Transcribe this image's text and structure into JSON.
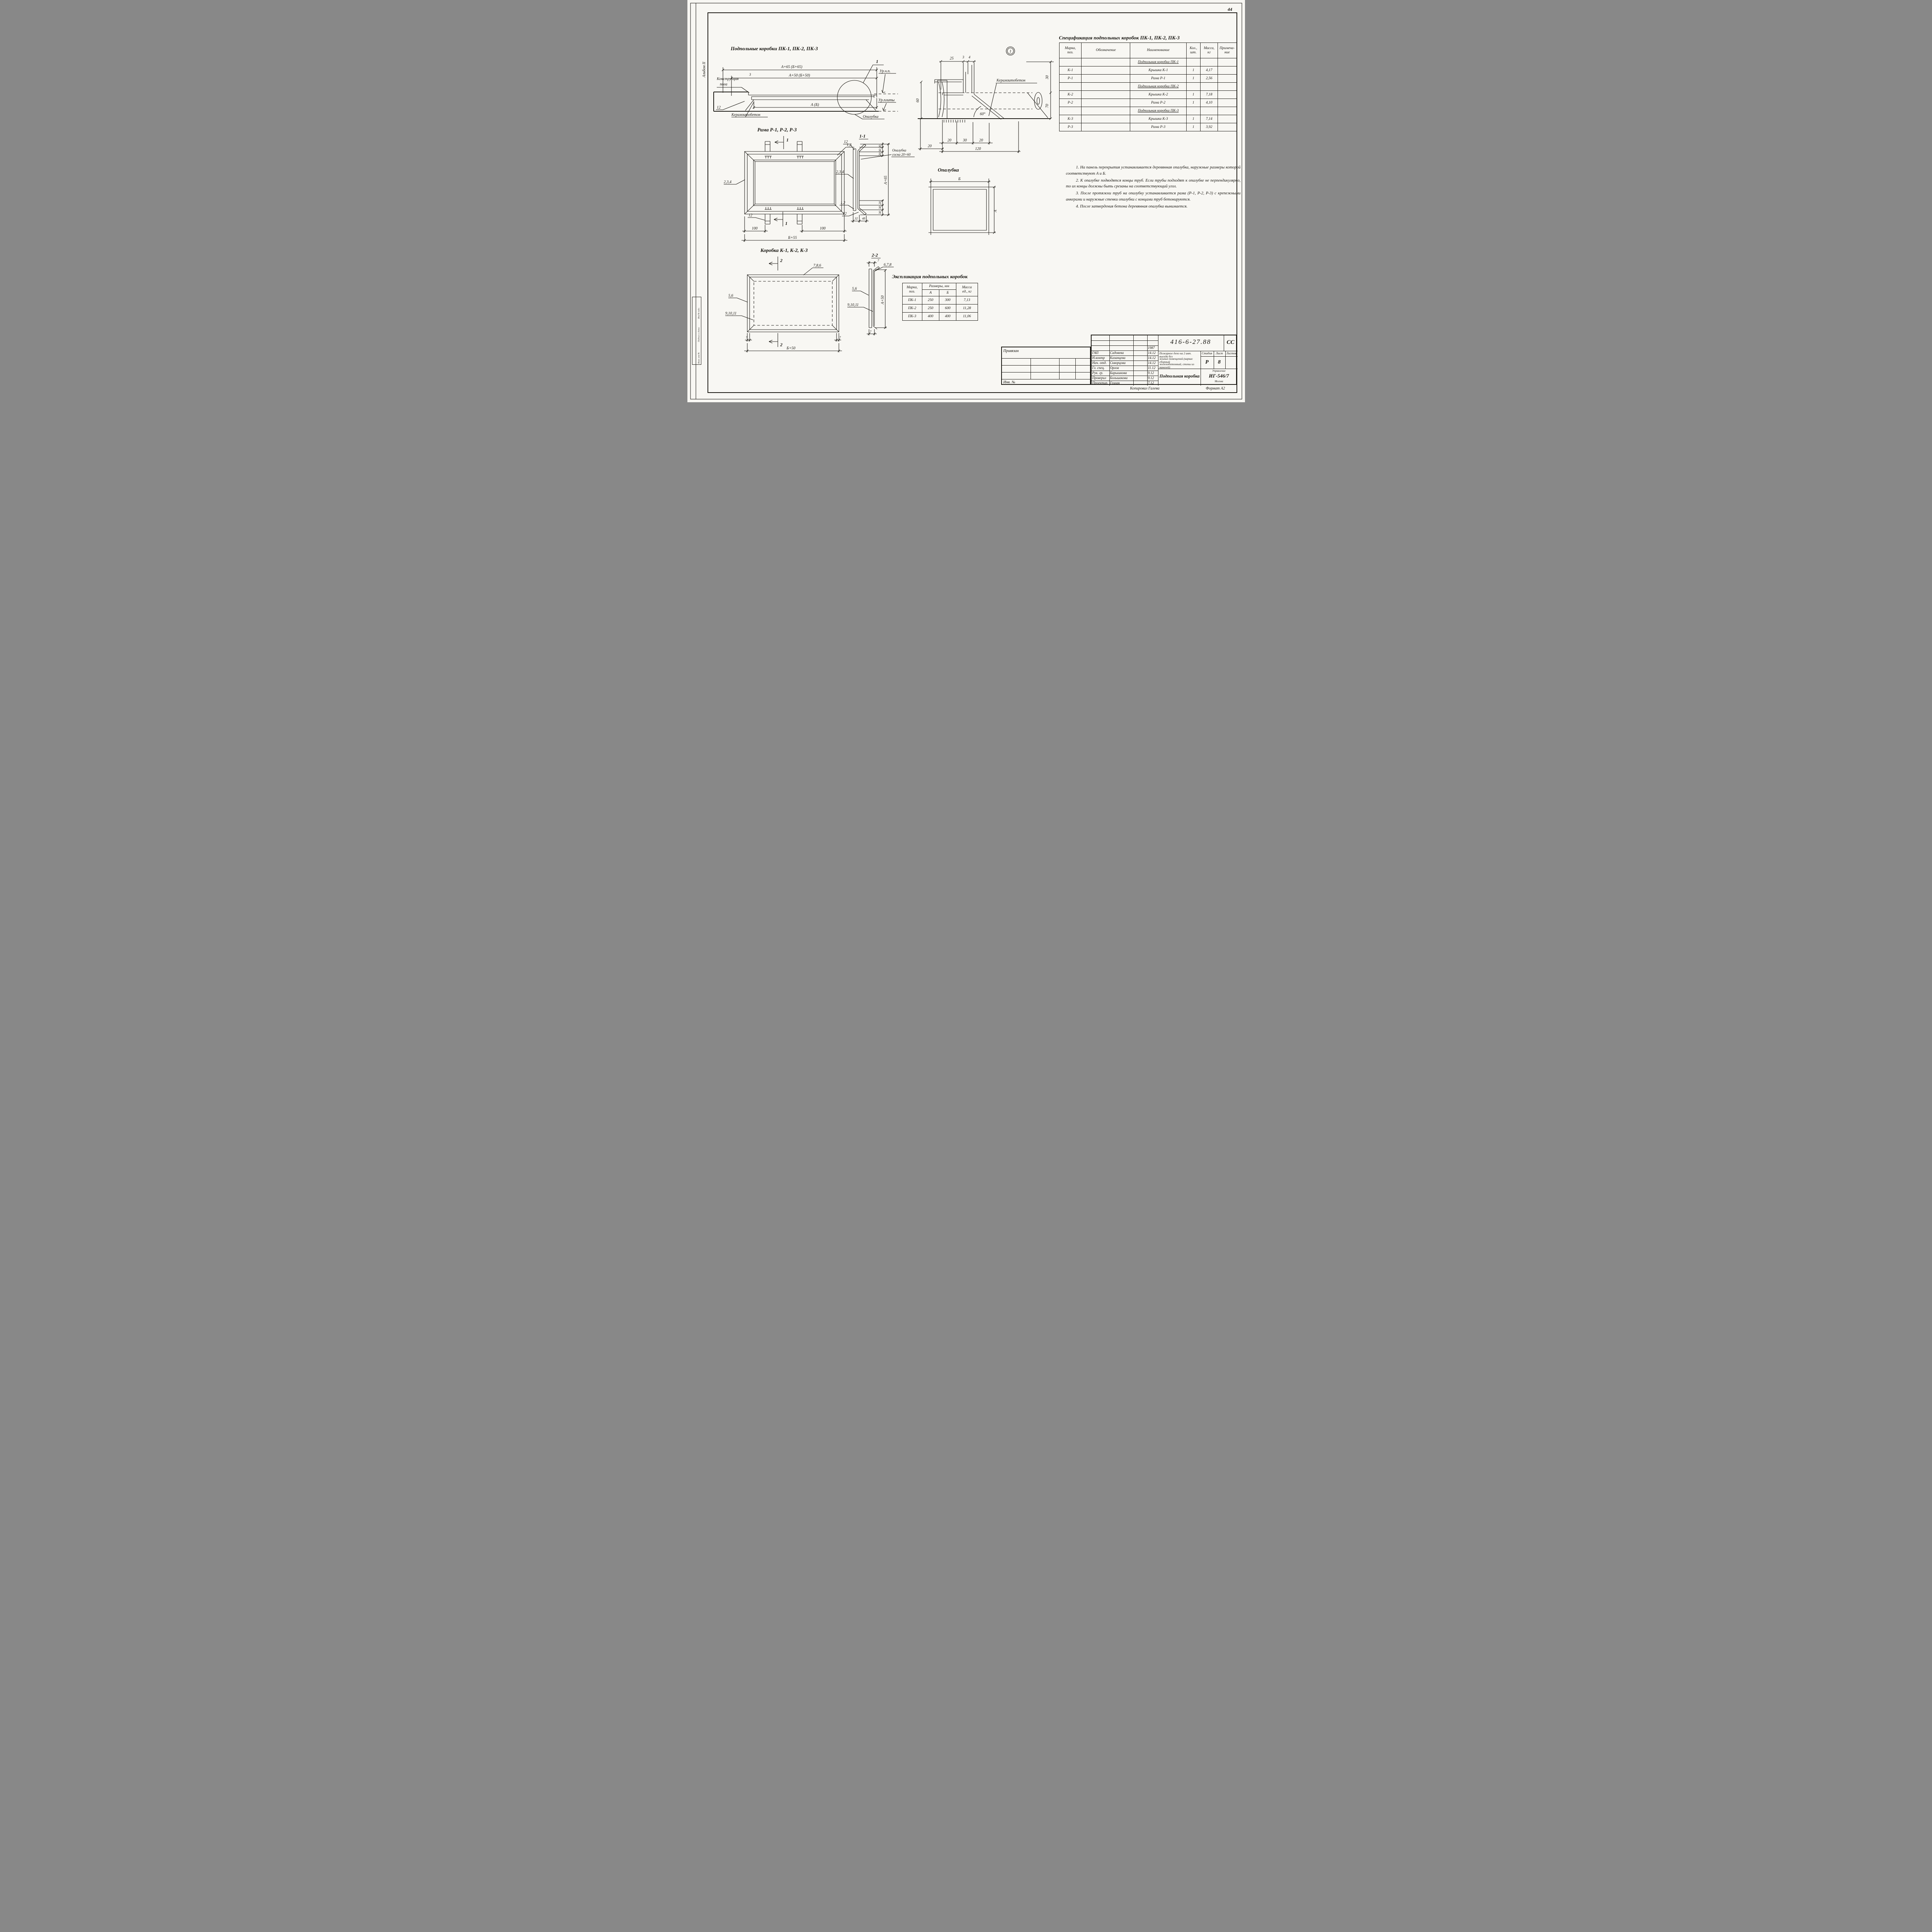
{
  "page": {
    "number": "44",
    "album_side_label": "Альбом II",
    "side_stamp": {
      "col1": "Инв.№ подл.",
      "col2": "Подпись и дата",
      "col3": "Взам. инв.№"
    },
    "copied_by": "Копировал Галева",
    "format": "Формат А2"
  },
  "floor_section": {
    "title": "Подпольные коробки ПК-1, ПК-2, ПК-3",
    "label_floor_1": "Конструкция",
    "label_floor_2": "пола",
    "dim_top_outer": "А+65 (Б+65)",
    "dim_top_inner": "А+50 (Б+50)",
    "dim_gap": "3",
    "dim_width": "А (Б)",
    "dim_thickness": "12",
    "label_concrete": "Керамзитобетон",
    "label_level_floor": "Ур.ч.п.",
    "label_level_slab": "Ур.плиты",
    "label_formwork": "Опалубка",
    "callout": "1"
  },
  "detail": {
    "callout": "1",
    "label_concrete": "Керамзитобетон",
    "dim_25": "25",
    "dim_3": "3",
    "dim_4": "4",
    "dim_30_right": "30",
    "dim_70_right": "70",
    "dim_60_left": "60",
    "dim_20a": "20",
    "dim_30m": "30",
    "dim_20b": "20",
    "dim_120": "120",
    "dim_20l": "20",
    "angle": "60°"
  },
  "frame_plan": {
    "title": "Рама Р-1, Р-2, Р-3",
    "section_mark": "1",
    "label_top": "1,2",
    "label_left": "2,3,4",
    "label_bottom": "12",
    "dim_left": "100",
    "dim_right": "100",
    "dim_total": "Б+55"
  },
  "section_1_1": {
    "title": "1-1",
    "label_top": "12",
    "label_mid": "2,3,4",
    "label_bottom1": "1,2",
    "label_bottom2": "12",
    "dim_32": "32",
    "dim_48": "48",
    "dims_right_top": [
      "20",
      "30",
      "20"
    ],
    "dim_total": "А+65",
    "dims_right_bottom": [
      "20",
      "30",
      "30"
    ],
    "note_1": "Опалубка",
    "note_2": "сосна 20×60"
  },
  "box_plan": {
    "title": "Коробка К-1, К-2, К-3",
    "section_mark": "2",
    "label_top": "7,8,6",
    "label_left1": "5,6",
    "label_left2": "9,10,11",
    "dim_7l": "7",
    "dim_7r": "7",
    "dim_total": "Б+50"
  },
  "section_2_2": {
    "title": "2-2",
    "label_top": "6,7,8",
    "label_left1": "5,6",
    "label_left2": "9,10,11",
    "dim_total": "А+50",
    "dim_7_top": "7",
    "dim_7_bottom": "7"
  },
  "formwork_plan": {
    "title": "Опалубка",
    "dim_b": "Б",
    "dim_a": "А"
  },
  "explication": {
    "title": "Экспликация подпольных коробок",
    "col_mark": "Марка,\nпоз.",
    "col_dims": "Размеры, мм",
    "col_a": "А",
    "col_b": "Б",
    "col_mass": "Масса\nед., кг",
    "rows": [
      [
        "ПК-1",
        "250",
        "300",
        "7,13"
      ],
      [
        "ПК-2",
        "250",
        "600",
        "11,28"
      ],
      [
        "ПК-3",
        "400",
        "400",
        "11,06"
      ]
    ]
  },
  "specification": {
    "title": "Спецификация подпольных коробок ПК-1, ПК-2, ПК-3",
    "col_mark": "Марка,\nпоз.",
    "col_designation": "Обозначение",
    "col_name": "Наименование",
    "col_qty": "Кол.,\nшт.",
    "col_mass": "Масса,\nкг",
    "col_note": "Примеча-\nние",
    "rows": [
      {
        "group": "Подпольная коробка ПК-1"
      },
      {
        "mark": "К-1",
        "name": "Крышка К-1",
        "qty": "1",
        "mass": "4,17"
      },
      {
        "mark": "Р-1",
        "name": "Рама Р-1",
        "qty": "1",
        "mass": "2,56"
      },
      {
        "group": "Подпольная коробка ПК-2"
      },
      {
        "mark": "К-2",
        "name": "Крышка К-2",
        "qty": "1",
        "mass": "7,18"
      },
      {
        "mark": "Р-2",
        "name": "Рама Р-2",
        "qty": "1",
        "mass": "4,10"
      },
      {
        "group": "Подпольная коробка ПК-3"
      },
      {
        "mark": "К-3",
        "name": "Крышка К-3",
        "qty": "1",
        "mass": "7,14"
      },
      {
        "mark": "Р-3",
        "name": "Рама Р-3",
        "qty": "1",
        "mass": "3,92"
      }
    ]
  },
  "notes": {
    "items": [
      "1. На панель перекрытия устанавливается деревянная опалубка, наружные размеры которой соответствуют А и Б.",
      "2. К опалубке подводятся концы труб. Если трубы подходят к опалубке не перпендикулярно, то их концы должны быть срезаны на соответствующий угол.",
      "3. После протяжки труб на опалубку устанавливается рама (Р-1, Р-2, Р-3) с крепежными анкерами и наружные стенки опалубки с концами труб бетонируются.",
      "4. После затвердения бетона деревянная опалубка вынимается."
    ]
  },
  "title_block": {
    "doc_number": "416-6-27.88",
    "code": "СС",
    "year": "1987",
    "rows": [
      {
        "role": "ГАП",
        "name": "Садовева",
        "date": "14.12"
      },
      {
        "role": "Н.контр",
        "name": "Казанцева",
        "date": "14.12"
      },
      {
        "role": "Нач. отд.",
        "name": "Скворцова",
        "date": "14.12"
      },
      {
        "role": "Гл. спец.",
        "name": "Орлов",
        "date": "11.12"
      },
      {
        "role": "Рук. гр.",
        "name": "Барышкова",
        "date": "9.12"
      },
      {
        "role": "Проверил",
        "name": "Большакова",
        "date": "9.12"
      },
      {
        "role": "Проектир.",
        "name": "Гозлан",
        "date": "7.12"
      }
    ],
    "description_1": "Пожарное депо на 2 авт. выезда без",
    "description_2": "жилых помещений (каркас сборный",
    "description_3": "железобетонный, стены из панелей)",
    "stage_label": "Стадия",
    "sheet_label": "Лист",
    "sheets_label": "Листов",
    "stage": "Р",
    "sheet": "8",
    "sheets": "",
    "drawing_title": "Подпольная коробка",
    "org_line1": "Управление",
    "org_line2": "ИГ-546/7",
    "org_line3": "Москва",
    "attached_label": "Привязан",
    "inv_label": "Инв. №"
  }
}
